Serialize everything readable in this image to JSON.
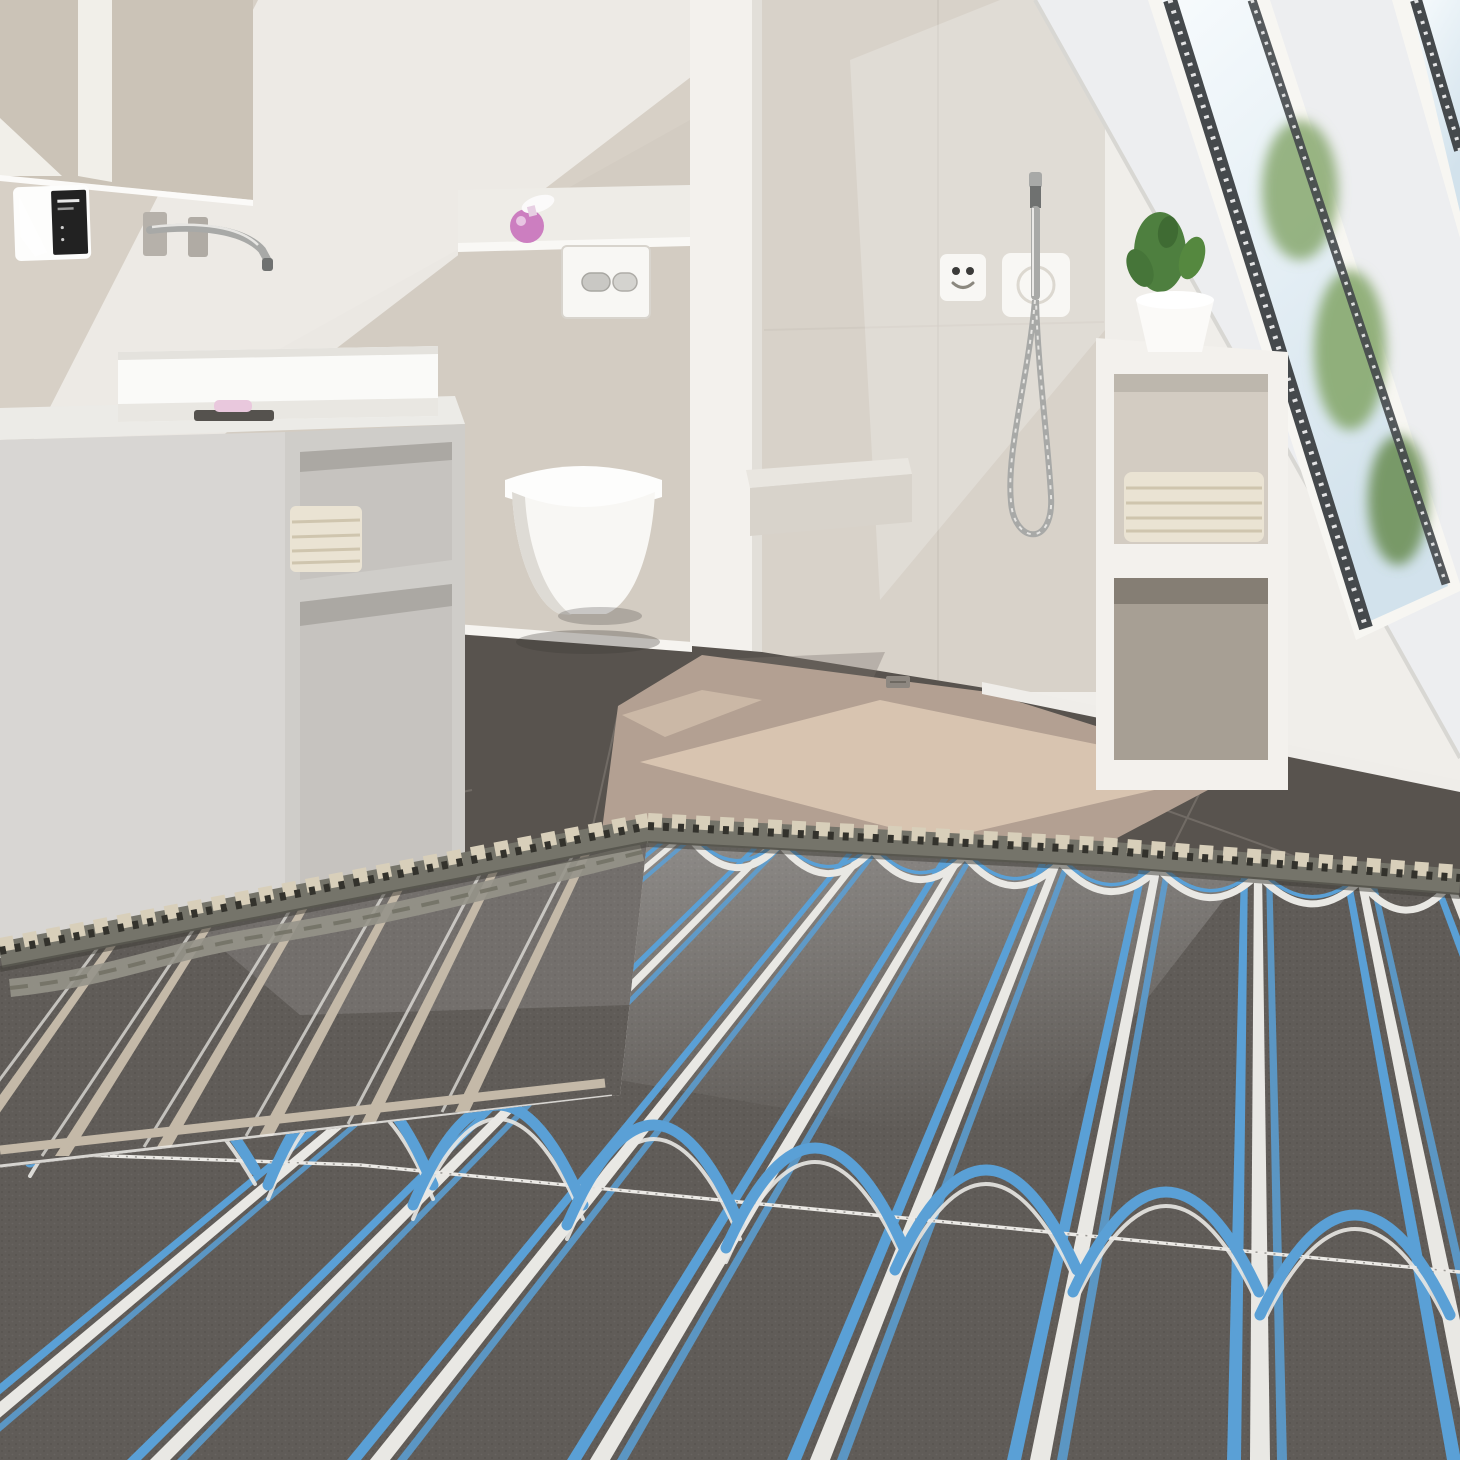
{
  "scene": {
    "type": "natural-image",
    "description": "3D product render of a modern attic bathroom during installation of electric underfloor heating: dark grey heating mats with blue heating cables in serpentine loops cover the foreground screed, an uncoupling membrane roll edge crosses the floor, behind it a sunlit beige walk-in shower area with dark grey floor tiles, a wall-hung toilet, a light grey vanity with white basin and wall faucet, a mirror, a wall thermostat, a hand shower on a coiled hose, built-in white shelving with towels and a cactus, and a sloped roof with skylight windows.",
    "objects": [
      "mirror",
      "wall-thermostat",
      "wall-faucet",
      "washbasin",
      "vanity-cabinet",
      "towel-stack",
      "soap-dish",
      "toilet-flush-plate",
      "soap-dispenser",
      "wall-hung-toilet",
      "shower-bench",
      "shower-control-panel",
      "hand-shower",
      "shower-hose",
      "shelving-unit",
      "cactus-plant",
      "skylight-window",
      "dark-floor-tiles",
      "screed-floor",
      "uncoupling-membrane",
      "heating-mat-left",
      "heating-mat-main",
      "heating-cables"
    ]
  },
  "palette": {
    "wall_white": "#f0eeea",
    "wall_beige": "#d7d0c6",
    "wall_greige": "#d3ccc2",
    "shower_wall": "#d8d2c9",
    "pillar_white": "#f3f1ed",
    "slope_white": "#edeef0",
    "sky_top": "#f7fbfd",
    "sky_bottom": "#d2e2ec",
    "foliage": "#87a86f",
    "frame_white": "#f7f6f2",
    "sash_dark": "#45494c",
    "mirror_beige": "#cbc3b7",
    "mirror_strip": "#f1efe9",
    "vanity_top": "#ecebe7",
    "vanity_front": "#d8d6d3",
    "vanity_side": "#cfcdc9",
    "vanity_inner": "#c6c3bf",
    "vanity_inner_dark": "#aba8a3",
    "basin_white": "#fafaf8",
    "towel_cream": "#eae3d3",
    "towel_shadow": "#cfc5ae",
    "toilet_white": "#f8f7f4",
    "toilet_shade": "#dedbd5",
    "chrome": "#a8a9a7",
    "chrome_dark": "#6f7170",
    "plate_white": "#f8f7f4",
    "screen_dark": "#222222",
    "pink": "#cc7ec0",
    "tile_dark": "#58534e",
    "tile_light": "#7b736c",
    "grout": "#8a847d",
    "screed": "#b3a092",
    "screed_sun": "#dbc8b4",
    "drain": "#8d8780",
    "mat_dark": "#605c58",
    "strip_white": "#e9e8e4",
    "strip_tan": "#c4b9a8",
    "cable_blue": "#5aa0d6",
    "cable_deep": "#3c7cb0",
    "membrane": "#75746a",
    "membrane_dark": "#33322c",
    "membrane_tab": "#d8cfba",
    "fleece": "#96948a",
    "bench": "#e9e6e0",
    "shadow": "#3c3936"
  }
}
